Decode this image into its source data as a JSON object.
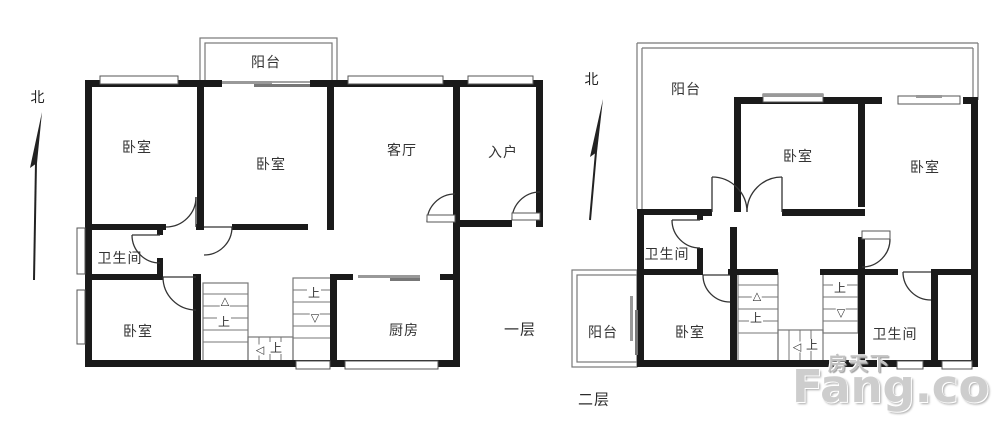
{
  "colors": {
    "wall": "#1a1a1a",
    "thin_line": "#777777",
    "door_arc": "#333333",
    "label_text": "#333333",
    "watermark_gray": "#cdcdcd",
    "background": "#ffffff"
  },
  "watermark": {
    "cn": "房天下",
    "en": "Fang.com"
  },
  "stairs": {
    "up": "上",
    "tri_up": "△",
    "tri_down": "▽",
    "tri_left": "◁"
  },
  "plans": [
    {
      "name": "first-floor",
      "floor_label": "一层",
      "north": "北",
      "rooms": {
        "balcony": "阳台",
        "bedroom_nw": "卧室",
        "bedroom_n": "卧室",
        "living": "客厅",
        "entry": "入户",
        "bathroom": "卫生间",
        "bedroom_sw": "卧室",
        "kitchen": "厨房"
      }
    },
    {
      "name": "second-floor",
      "floor_label": "二层",
      "north": "北",
      "rooms": {
        "balcony_top": "阳台",
        "bedroom_n": "卧室",
        "bedroom_ne": "卧室",
        "bathroom_w": "卫生间",
        "balcony_sw": "阳台",
        "bedroom_s": "卧室",
        "bathroom_e": "卫生间"
      }
    }
  ]
}
